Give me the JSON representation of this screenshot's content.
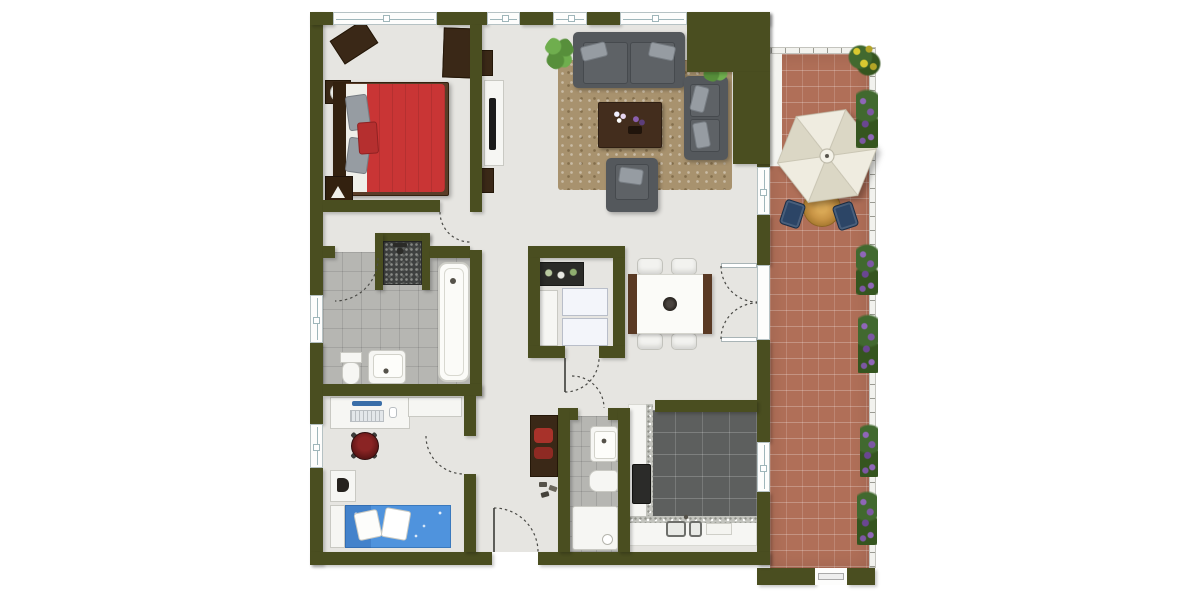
{
  "meta": {
    "view": "apartment-floor-plan-top-view",
    "canvas_width": 1200,
    "canvas_height": 600
  },
  "palette": {
    "background": "#ffffff",
    "wall": "#4a4e20",
    "floor": "#e6e5e1",
    "bath_tile": "#b6b6b2",
    "kitchen_tile": "#5d5f5e",
    "terrace_brick": "#b06f58",
    "rug": "#a8926e",
    "sofa": "#54585c",
    "sofa_cushion": "#969ca2",
    "bed_red": "#c93535",
    "bed_blue": "#4f93dd",
    "wood_dark": "#3a2817",
    "wood_mid": "#5a3d28",
    "white_furniture": "#f6f6f3",
    "umbrella_light": "#efece0",
    "umbrella_shade": "#dbd7c5",
    "terrace_table": "#c89445",
    "terrace_chair": "#2c4566",
    "plant_green": "#2e5a1e",
    "flower_purple": "#7c57a3",
    "flower_yellow": "#d8c830",
    "door_arc": "#4a4a46"
  },
  "rooms": [
    {
      "name": "bedroom"
    },
    {
      "name": "living-room"
    },
    {
      "name": "dining-area"
    },
    {
      "name": "main-bathroom"
    },
    {
      "name": "storage-laundry-room"
    },
    {
      "name": "kids-room-office"
    },
    {
      "name": "hallway"
    },
    {
      "name": "guest-bathroom"
    },
    {
      "name": "kitchen"
    },
    {
      "name": "terrace"
    }
  ],
  "counts": {
    "windows": 9,
    "door_swings": 8,
    "terrace_flower_boxes": 6,
    "living_room_plants": 3,
    "bar_stools": 4,
    "dining_chairs": 4,
    "terrace_chairs": 2
  }
}
